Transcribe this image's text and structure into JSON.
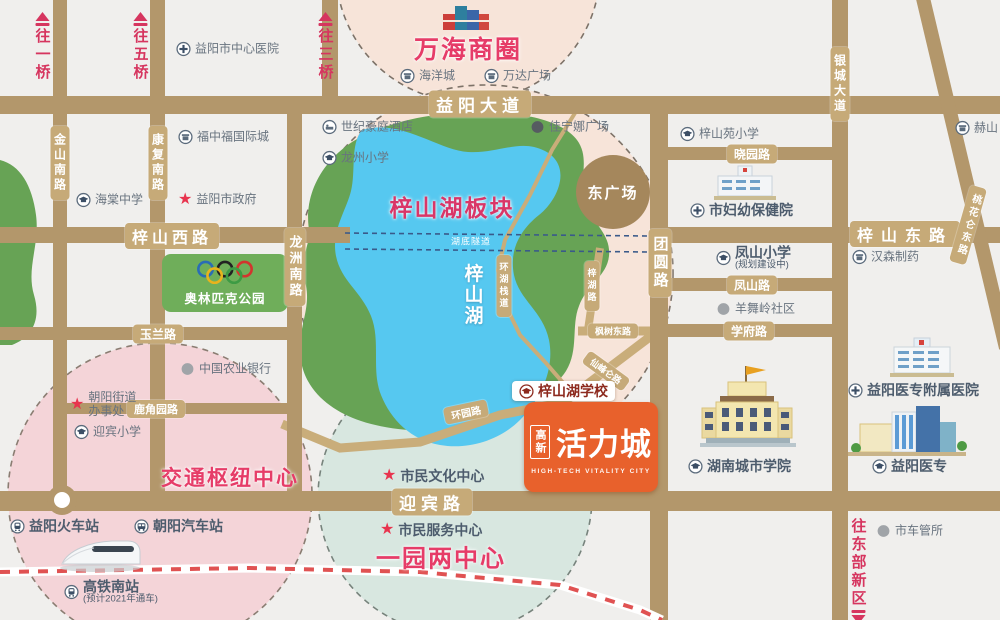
{
  "palette": {
    "road": "#b3976b",
    "road_label_bg": "#c6aa78",
    "lake": "#56c8f0",
    "park": "#67a355",
    "pink_zone_text": "#e63c68",
    "crimson": "#d6355f",
    "poi_text": "#68737f",
    "circle_pink": "#f7e4d9",
    "circle_pink_deep": "#f4d4d8",
    "circle_teal": "#d8e7e0",
    "logo_orange": "#e8612c",
    "plaza_brown": "#a5875c"
  },
  "zones": [
    {
      "text": "万海商圈",
      "x": 468,
      "y": 48,
      "size": 25,
      "color": "#e63c68"
    },
    {
      "text": "梓山湖板块",
      "x": 452,
      "y": 206,
      "size": 23,
      "color": "#d93668"
    },
    {
      "text": "交通枢纽中心",
      "x": 230,
      "y": 477,
      "size": 21,
      "color": "#e63c68"
    },
    {
      "text": "一园两中心",
      "x": 441,
      "y": 556,
      "size": 24,
      "color": "#e63c68"
    },
    {
      "text": "梓山湖",
      "x": 472,
      "y": 295,
      "size": 19,
      "color": "#ffffff",
      "vertical": true
    }
  ],
  "plaza": {
    "label": "东广场"
  },
  "olympic": {
    "label": "奥林匹克公园"
  },
  "logo": {
    "side": "高新",
    "title": "活力城",
    "subtitle": "HIGH-TECH VITALITY CITY"
  },
  "offmap_arrows": [
    {
      "text": "往一桥",
      "x": 42,
      "y": 12,
      "dir": "up"
    },
    {
      "text": "往五桥",
      "x": 140,
      "y": 12,
      "dir": "up"
    },
    {
      "text": "往三桥",
      "x": 325,
      "y": 12,
      "dir": "up"
    },
    {
      "text": "往东部新区",
      "x": 858,
      "y": 518,
      "dir": "down"
    }
  ],
  "road_labels": [
    {
      "text": "益阳大道",
      "x": 480,
      "y": 104,
      "orient": "h",
      "size": 17,
      "bold": true,
      "spacing": 5
    },
    {
      "text": "梓山西路",
      "x": 172,
      "y": 236,
      "orient": "h",
      "size": 16,
      "bold": true,
      "spacing": 4
    },
    {
      "text": "梓山东路",
      "x": 905,
      "y": 234,
      "orient": "h",
      "size": 16,
      "bold": true,
      "spacing": 8
    },
    {
      "text": "迎宾路",
      "x": 432,
      "y": 502,
      "orient": "h",
      "size": 17,
      "bold": true,
      "spacing": 5
    },
    {
      "text": "晓园路",
      "x": 752,
      "y": 154,
      "orient": "h",
      "size": 12
    },
    {
      "text": "凤山路",
      "x": 752,
      "y": 285,
      "orient": "h",
      "size": 12
    },
    {
      "text": "学府路",
      "x": 749,
      "y": 331,
      "orient": "h",
      "size": 12
    },
    {
      "text": "玉兰路",
      "x": 158,
      "y": 334,
      "orient": "h",
      "size": 12
    },
    {
      "text": "鹿角园路",
      "x": 156,
      "y": 409,
      "orient": "h",
      "size": 11
    },
    {
      "text": "金山南路",
      "x": 60,
      "y": 163,
      "orient": "v",
      "size": 12
    },
    {
      "text": "康复南路",
      "x": 158,
      "y": 163,
      "orient": "v",
      "size": 12
    },
    {
      "text": "龙洲南路",
      "x": 295,
      "y": 267,
      "orient": "v",
      "size": 13
    },
    {
      "text": "团圆路",
      "x": 660,
      "y": 263,
      "orient": "v",
      "size": 15,
      "bold": true
    },
    {
      "text": "银城大道",
      "x": 840,
      "y": 84,
      "orient": "v",
      "size": 12
    },
    {
      "text": "桃花仑东路",
      "x": 968,
      "y": 225,
      "orient": "v",
      "size": 10,
      "rotate": 16
    },
    {
      "text": "梓湖路",
      "x": 592,
      "y": 286,
      "orient": "v",
      "size": 9
    },
    {
      "text": "环湖栈道",
      "x": 504,
      "y": 286,
      "orient": "v",
      "size": 9
    },
    {
      "text": "枫树东路",
      "x": 613,
      "y": 331,
      "orient": "h",
      "size": 9
    },
    {
      "text": "仙峰仑路",
      "x": 606,
      "y": 371,
      "orient": "h",
      "size": 9,
      "rotate": 36
    },
    {
      "text": "环园路",
      "x": 466,
      "y": 412,
      "orient": "h",
      "size": 10,
      "rotate": -12
    },
    {
      "text": "湖底隧道",
      "x": 471,
      "y": 241,
      "orient": "h",
      "size": 9,
      "plain": true
    }
  ],
  "pois": [
    {
      "label": "益阳市中心医院",
      "icon": "hospital",
      "x": 176,
      "y": 49
    },
    {
      "label": "福中福国际城",
      "icon": "shop",
      "x": 178,
      "y": 137
    },
    {
      "label": "海棠中学",
      "icon": "school",
      "x": 76,
      "y": 200
    },
    {
      "label": "益阳市政府",
      "icon": "star",
      "x": 178,
      "y": 200
    },
    {
      "label": "世纪豪庭酒店",
      "icon": "hotel",
      "x": 322,
      "y": 127
    },
    {
      "label": "龙州小学",
      "icon": "school",
      "x": 322,
      "y": 158
    },
    {
      "label": "海洋城",
      "icon": "shop",
      "x": 400,
      "y": 76
    },
    {
      "label": "万达广场",
      "icon": "shop",
      "x": 484,
      "y": 76
    },
    {
      "label": "佳宁娜广场",
      "icon": "dot-dark",
      "x": 530,
      "y": 127
    },
    {
      "label": "梓山苑小学",
      "icon": "school",
      "x": 680,
      "y": 134
    },
    {
      "label": "市妇幼保健院",
      "icon": "hospital",
      "x": 690,
      "y": 210,
      "bold": true
    },
    {
      "label": "凤山小学",
      "sub": "(规划建设中)",
      "icon": "school",
      "x": 716,
      "y": 258,
      "bold": true
    },
    {
      "label": "羊舞岭社区",
      "icon": "dot-gray",
      "x": 716,
      "y": 309
    },
    {
      "label": "汉森制药",
      "icon": "shop",
      "x": 852,
      "y": 257
    },
    {
      "label": "赫山",
      "icon": "shop",
      "x": 955,
      "y": 128
    },
    {
      "label": "中国农业银行",
      "icon": "dot-gray",
      "x": 180,
      "y": 369
    },
    {
      "label": "朝阳街道\n办事处",
      "icon": "star",
      "x": 70,
      "y": 405
    },
    {
      "label": "迎宾小学",
      "icon": "school",
      "x": 74,
      "y": 432
    },
    {
      "label": "益阳火车站",
      "icon": "train",
      "x": 10,
      "y": 526,
      "bold": true
    },
    {
      "label": "朝阳汽车站",
      "icon": "bus",
      "x": 134,
      "y": 526,
      "bold": true
    },
    {
      "label": "高铁南站",
      "sub": "(预计2021年通车)",
      "icon": "train",
      "x": 64,
      "y": 592,
      "bold": true
    },
    {
      "label": "市民文化中心",
      "icon": "star",
      "x": 382,
      "y": 476,
      "bold": true
    },
    {
      "label": "市民服务中心",
      "icon": "star",
      "x": 380,
      "y": 530,
      "bold": true
    },
    {
      "label": "湖南城市学院",
      "icon": "school",
      "x": 688,
      "y": 466,
      "bold": true
    },
    {
      "label": "益阳医专",
      "icon": "school",
      "x": 872,
      "y": 466,
      "bold": true
    },
    {
      "label": "益阳医专附属医院",
      "icon": "hospital",
      "x": 848,
      "y": 390,
      "bold": true
    },
    {
      "label": "市车管所",
      "icon": "dot-gray",
      "x": 876,
      "y": 531
    },
    {
      "label": "梓山湖学校",
      "icon": "school-red",
      "x": 512,
      "y": 391,
      "boxed": true
    }
  ]
}
